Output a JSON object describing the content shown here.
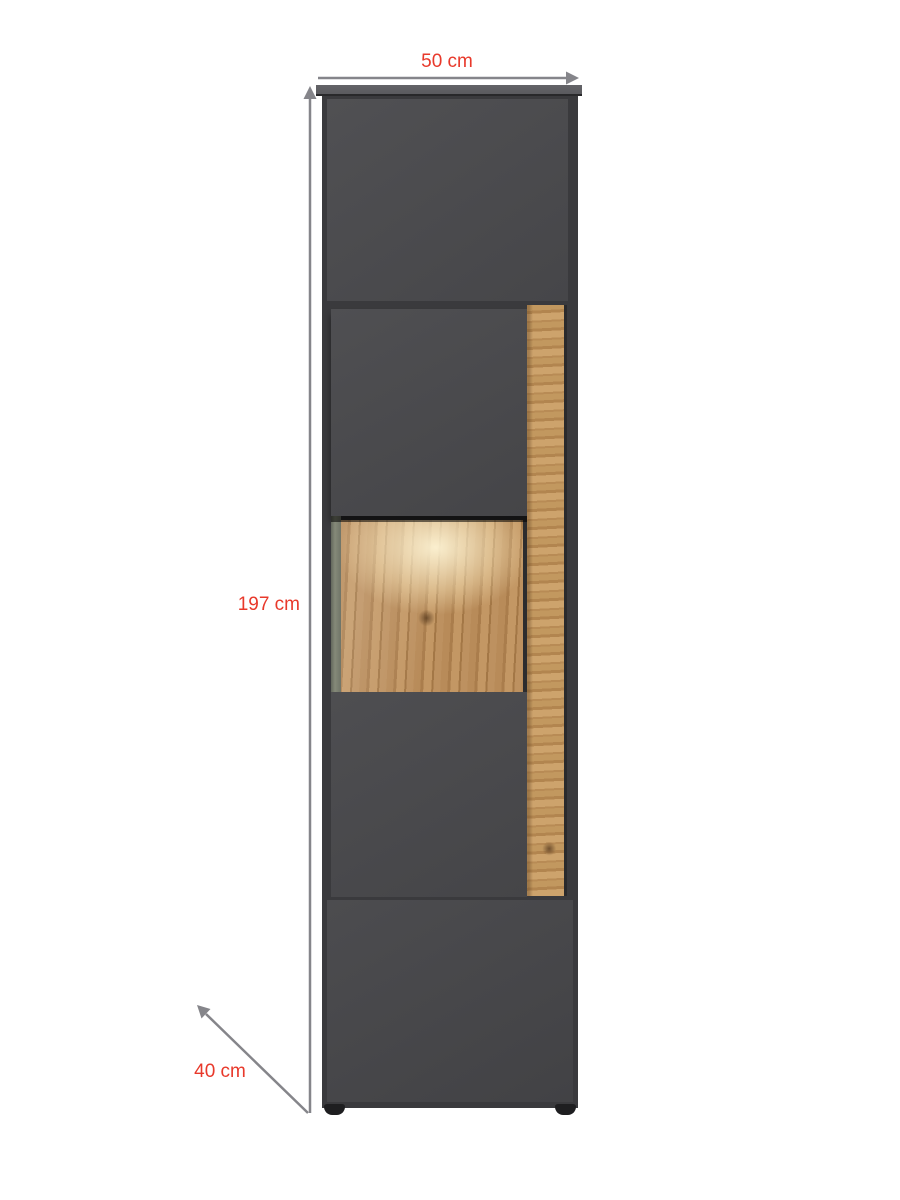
{
  "image": {
    "type": "furniture dimension diagram",
    "background": "#ffffff"
  },
  "product": {
    "name": "tall display cabinet, anthracite grey with oak wood accent and lighted glass compartment",
    "colors": {
      "front": "#4b4b4e",
      "frame": "#3a3a3d",
      "top_board": "#5b5b5f",
      "wood": "#b98c5a",
      "feet": "#1e1e20"
    }
  },
  "annotations": {
    "label_color": "#e8392b",
    "arrow_color": "#85858a",
    "width_label": "50 cm",
    "height_label": "197 cm",
    "depth_label": "40 cm"
  }
}
